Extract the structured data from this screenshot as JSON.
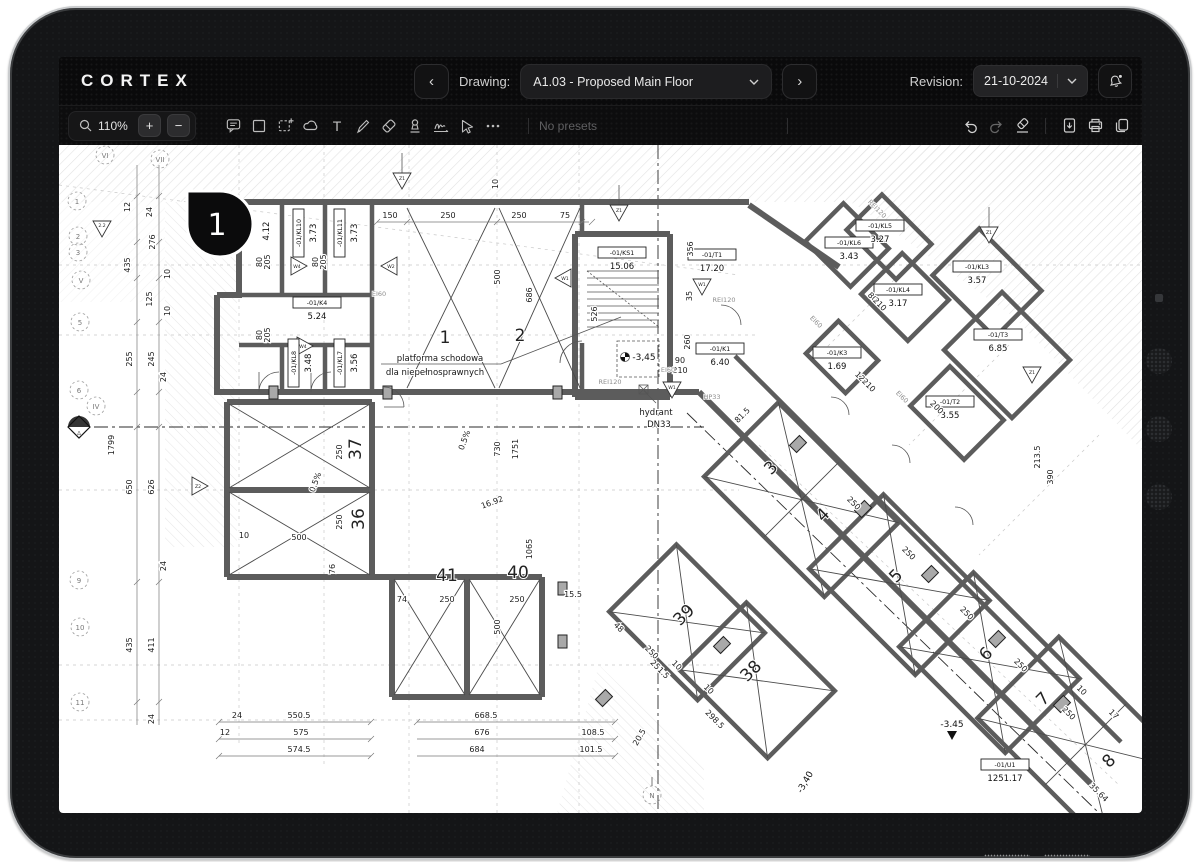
{
  "header": {
    "logo": "CORTEX",
    "nav_prev": "‹",
    "nav_next": "›",
    "drawing_label": "Drawing:",
    "drawing_value": "A1.03 - Proposed Main Floor",
    "revision_label": "Revision:",
    "revision_value": "21-10-2024"
  },
  "toolbar": {
    "zoom": "110%",
    "zoom_in": "+",
    "zoom_out": "−",
    "text_tool": "T",
    "more": "⋯",
    "no_presets": "No presets",
    "icons": [
      "magnifier",
      "comment",
      "rectangle",
      "marquee-select",
      "cloud",
      "text",
      "pen",
      "eraser",
      "stamp",
      "signature",
      "pointer",
      "more",
      "undo",
      "redo",
      "clear-eraser",
      "export-file",
      "print",
      "copy"
    ],
    "accent_dark": "#0a0a0b",
    "icon_color": "#bdbdbd"
  },
  "plan": {
    "marker": "1",
    "tags": [
      {
        "id": "-01/KL10",
        "a": "3.73"
      },
      {
        "id": "-01/KL11",
        "a": "3.73"
      },
      {
        "id": "",
        "a": "4.12"
      },
      {
        "id": "-01/K4",
        "a": "5.24"
      },
      {
        "id": "-01/KL8",
        "a": "3.48"
      },
      {
        "id": "-01/KL7",
        "a": "3.56"
      },
      {
        "id": "-01/KS1",
        "a": "15.06"
      },
      {
        "id": "-01/T1",
        "a": "17.20"
      },
      {
        "id": "-01/K1",
        "a": "6.40"
      },
      {
        "id": "-01/KL6",
        "a": "3.43"
      },
      {
        "id": "-01/KL5",
        "a": "3.27"
      },
      {
        "id": "-01/KL4",
        "a": "3.17"
      },
      {
        "id": "-01/KL3",
        "a": "3.57"
      },
      {
        "id": "-01/K3",
        "a": "1.69"
      },
      {
        "id": "-01/T3",
        "a": "6.85"
      },
      {
        "id": "-01/T2",
        "a": "3.55"
      },
      {
        "id": "-01/U1",
        "a": "1251.17"
      }
    ],
    "nums": {
      "c1": "1",
      "c2": "2",
      "r37": "37",
      "r36": "36",
      "r41": "41",
      "r40": "40",
      "r39": "39",
      "r38": "38",
      "w3": "3",
      "w4": "4",
      "w5": "5",
      "w6": "6",
      "w7": "7",
      "w8": "8"
    },
    "grid": {
      "gVI": "VI",
      "gVII": "VII",
      "g1": "1",
      "g2": "2",
      "g3": "3",
      "gV": "V",
      "g5": "5",
      "g6": "6",
      "gIV": "IV",
      "g9": "9",
      "g10": "10",
      "g11": "11",
      "gA": "A",
      "gN": "N"
    },
    "dv": {
      "v10": "10",
      "v12": "12",
      "v15_5": "15.5",
      "v16_92": "16.92",
      "v17": "17",
      "v20_5": "20.5",
      "v24": "24",
      "v35": "35",
      "v35_64": "35.64",
      "v48": "48",
      "v74": "74",
      "v75": "75",
      "v76": "76",
      "v80": "80",
      "v81_5": "81.5",
      "v90": "90",
      "v101_5": "101.5",
      "v108_5": "108.5",
      "v120": "120",
      "v125": "125",
      "v150": "150",
      "v200": "200",
      "v205": "205",
      "v210": "210",
      "v213_5": "213.5",
      "v245": "245",
      "v250": "250",
      "v251_5": "251.5",
      "v255": "255",
      "v260": "260",
      "v276": "276",
      "v298_5": "298.5",
      "v356": "356",
      "v390": "390",
      "v411": "411",
      "v435": "435",
      "v500": "500",
      "v526": "526",
      "v550_5": "550.5",
      "v574_5": "574.5",
      "v575": "575",
      "v626": "626",
      "v650": "650",
      "v668_5": "668.5",
      "v676": "676",
      "v684": "684",
      "v686": "686",
      "v730": "730",
      "v1065": "1065",
      "v1751": "1751",
      "v1799": "1799",
      "slope": "0.5%"
    },
    "fire": {
      "rei": "REI120",
      "ei": "EI60",
      "hp": "HP33"
    },
    "notes": {
      "p1": "platforma schodowa",
      "p2": "dla niepełnosprawnych",
      "h1": "hydrant",
      "h2": "DN33"
    },
    "levels": {
      "l1": "-3,45",
      "l2": "-3,40",
      "l3": "-3.45"
    },
    "tri": {
      "w1": "W1",
      "w2": "W2",
      "w4": "W4",
      "z1": "Z1",
      "z2": "Z2",
      "t22": "2.2"
    }
  }
}
